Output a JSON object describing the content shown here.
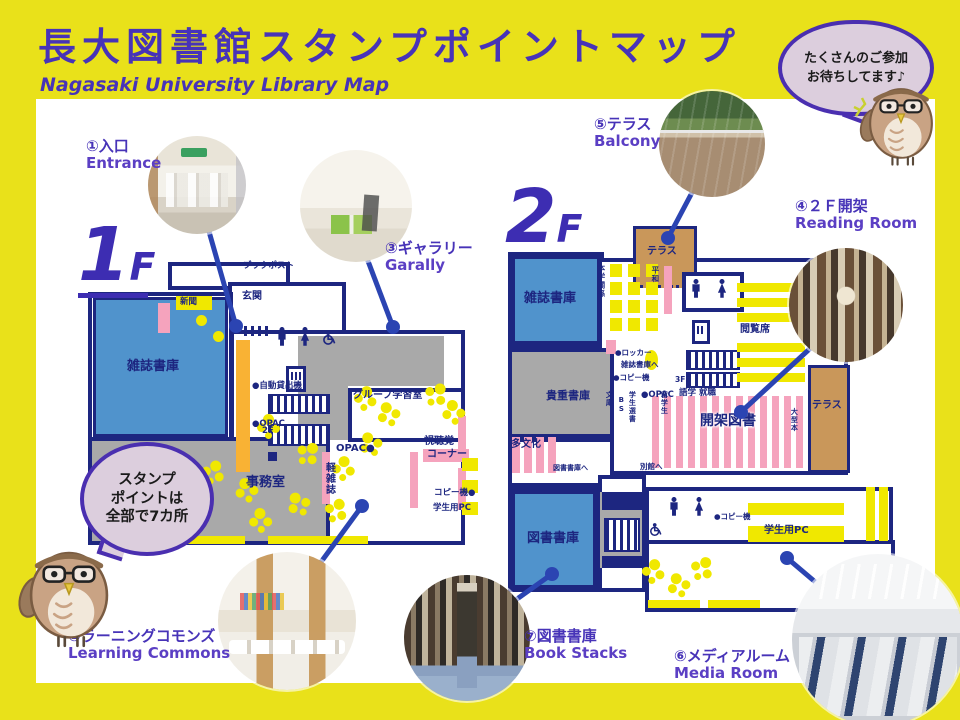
{
  "title": {
    "jp": "長大図書館スタンプポイントマップ",
    "en": "Nagasaki University Library Map"
  },
  "bubbles": {
    "invite": [
      "たくさんのご参加",
      "お待ちしてます♪"
    ],
    "stamp": [
      "スタンプ",
      "ポイントは",
      "全部で7カ所"
    ]
  },
  "floors": {
    "f1": {
      "num": "1",
      "suffix": "F"
    },
    "f2": {
      "num": "2",
      "suffix": "F"
    }
  },
  "points": [
    {
      "jp": "①入口",
      "en": "Entrance"
    },
    {
      "jp": "②ラーニングコモンズ",
      "en": "Learning Commons"
    },
    {
      "jp": "③ギャラリー",
      "en": "Garally"
    },
    {
      "jp": "④２Ｆ開架",
      "en": "Reading Room"
    },
    {
      "jp": "⑤テラス",
      "en": "Balcony"
    },
    {
      "jp": "⑥メディアルーム",
      "en": "Media Room"
    },
    {
      "jp": "⑦図書書庫",
      "en": "Book Stacks"
    }
  ],
  "map_labels": {
    "f1_bookpost": "ブックポスト",
    "f1_genkan": "玄関",
    "f1_shinbun": "新聞",
    "f1_zasshi_shoko": "雑誌書庫",
    "f1_jido": "●自動貸出機",
    "f1_opac_counter": "●OPAC",
    "f1_stairs2f": "2F",
    "f1_group": "グループ学習室",
    "f1_opac2": "OPAC●",
    "f1_shichokaku": "視聴覚",
    "f1_corner": "コーナー",
    "f1_copy": "コピー機●",
    "f1_pc": "学生用PC",
    "f1_keizasshi": "軽雑誌",
    "f1_jimushitsu": "事務室",
    "f2_zasshi_shoko": "雑誌書庫",
    "f2_kicho": "貴重書庫",
    "f2_tosho_shoko": "図書書庫",
    "f2_terrace_top": "テラス",
    "f2_terrace_right": "テラス",
    "f2_hongaku": "本学関係",
    "f2_heiwa": "平和",
    "f2_locker": "●ロッカー",
    "f2_zasshi_e": "雑誌書庫へ",
    "f2_copy1": "●コピー機",
    "f2_opac": "●OPAC",
    "f2_stairs3f": "3F",
    "f2_gogaku": "語学 就職",
    "f2_bunko": "文庫",
    "f2_bs": "BS",
    "f2_sensho": "学生選書",
    "f2_ryugaku": "留学生",
    "f2_kaika": "開架図書",
    "f2_etsuran": "閲覧席",
    "f2_ogata": "大型本",
    "f2_tabunka": "多文化",
    "f2_toshoshoko_e": "図書書庫へ",
    "f2_bekkan": "別館へ",
    "f2_copy2": "●コピー機",
    "f2_pc": "学生用PC"
  },
  "colors": {
    "background": "#e9e11a",
    "accent_purple": "#4733b8",
    "wall_navy": "#1d2680",
    "room_blue": "#5093cc",
    "room_gray": "#a9a9a9",
    "shelf_pink": "#f5a3bd",
    "counter_orange": "#f9b234",
    "terrace_tan": "#c9975a",
    "map_yellow": "#f0e800",
    "connector_blue": "#2b44b2",
    "bubble_fill": "#dccedd"
  }
}
